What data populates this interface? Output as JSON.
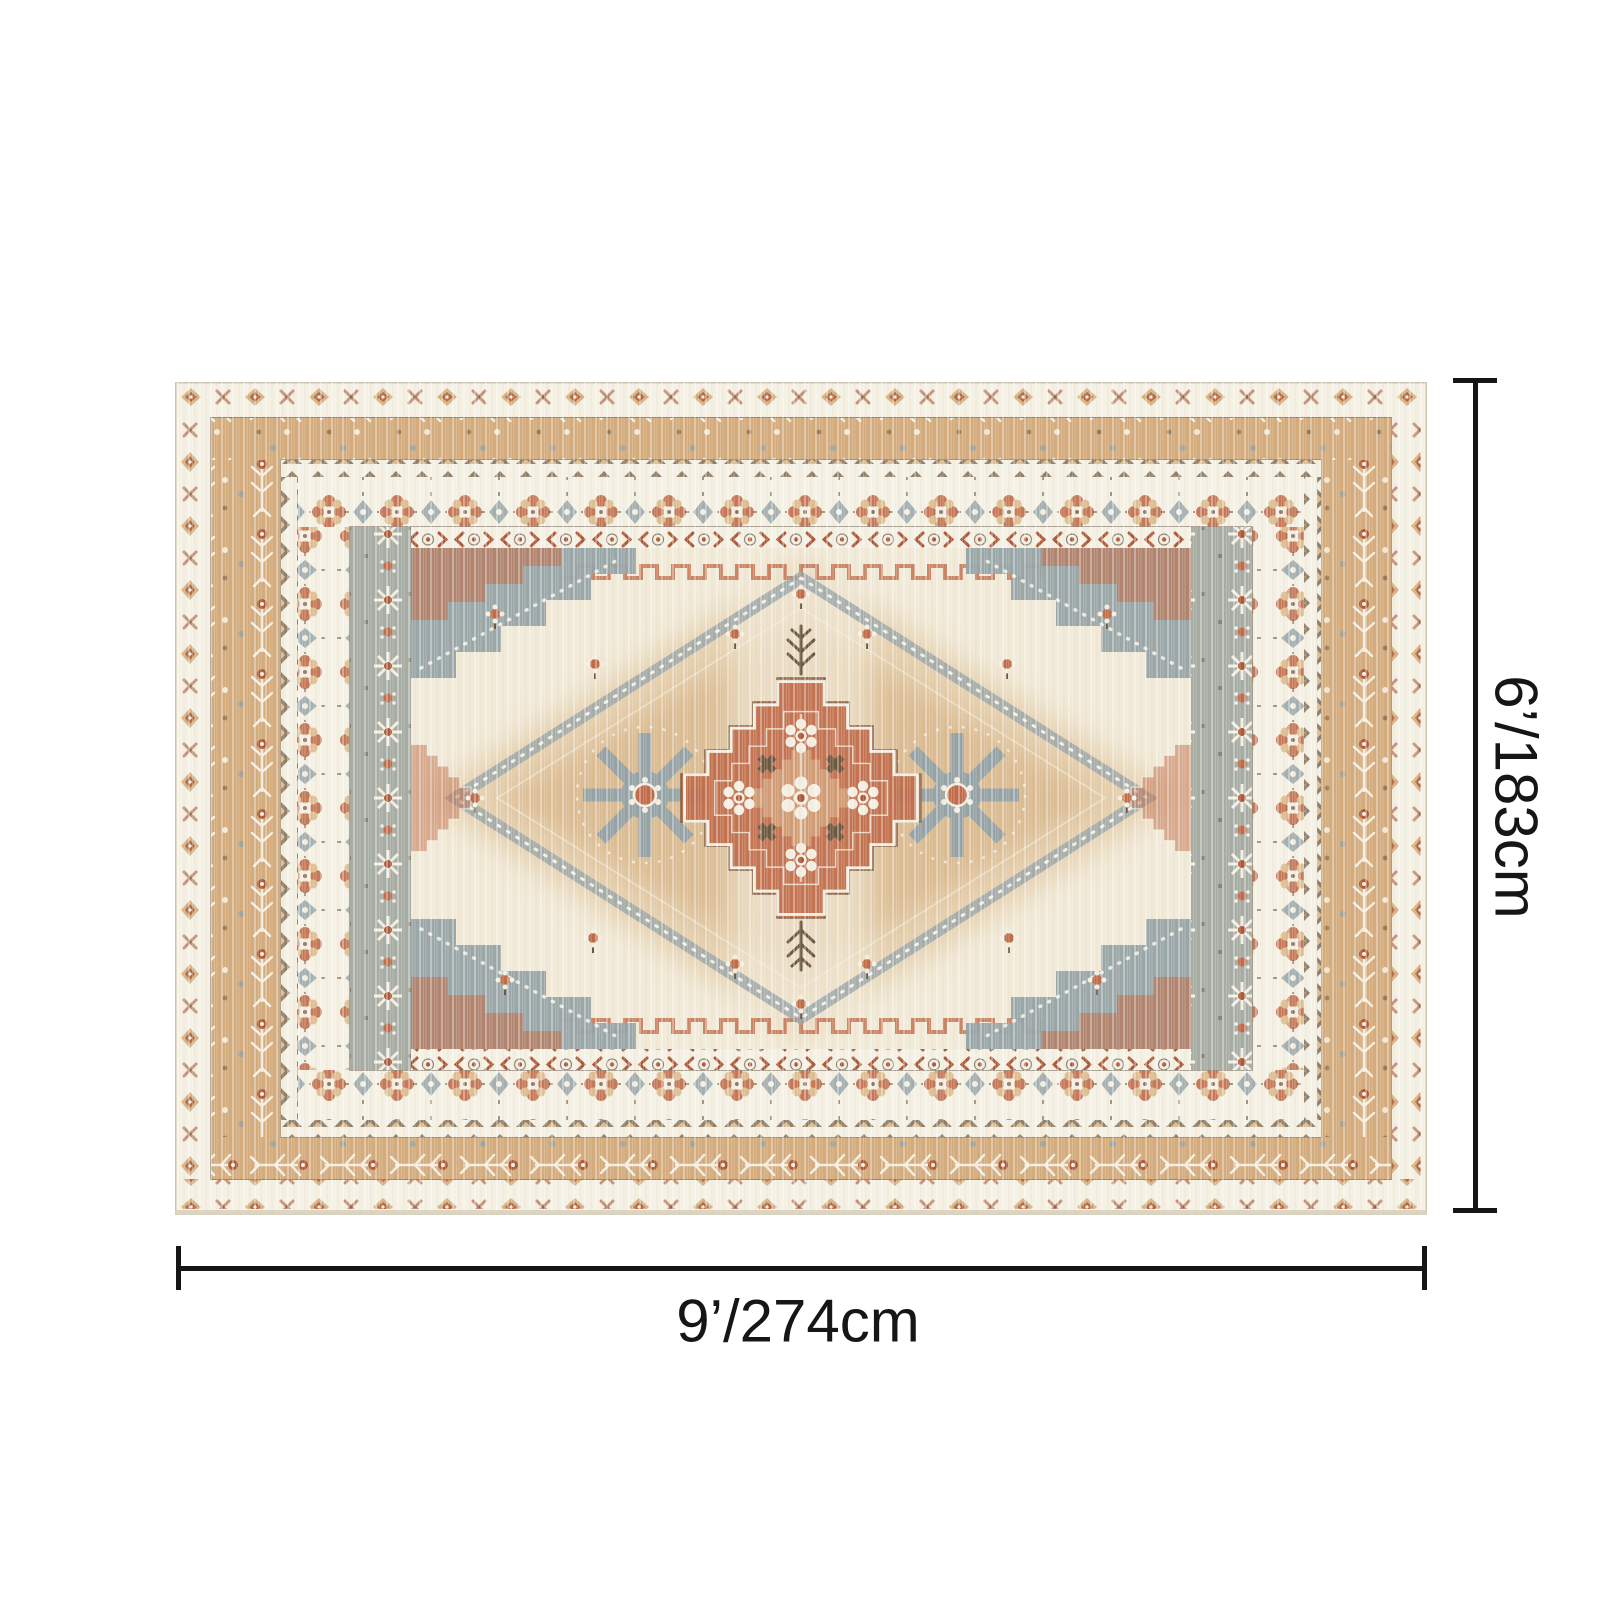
{
  "figure": {
    "subject": "vintage oriental medallion area rug",
    "view": "top-down product dimension diagram",
    "background": "#ffffff"
  },
  "annotations": {
    "vertical_dimension": {
      "label": "6’/183cm"
    },
    "horizontal_dimension": {
      "label": "9’/274cm"
    }
  },
  "palette": {
    "line": "#161616",
    "ivory": "#f4f0e4",
    "cream": "#f1ead8",
    "tan": "#d3ab7c",
    "gold": "#ddbe92",
    "terracotta": "#c06c4a",
    "rust": "#ad5a3a",
    "gray": "#a6aca4",
    "grayblue": "#95a3a7",
    "brown": "#6d5942",
    "darkline": "#8e8273",
    "edge": "#cec5ae"
  }
}
